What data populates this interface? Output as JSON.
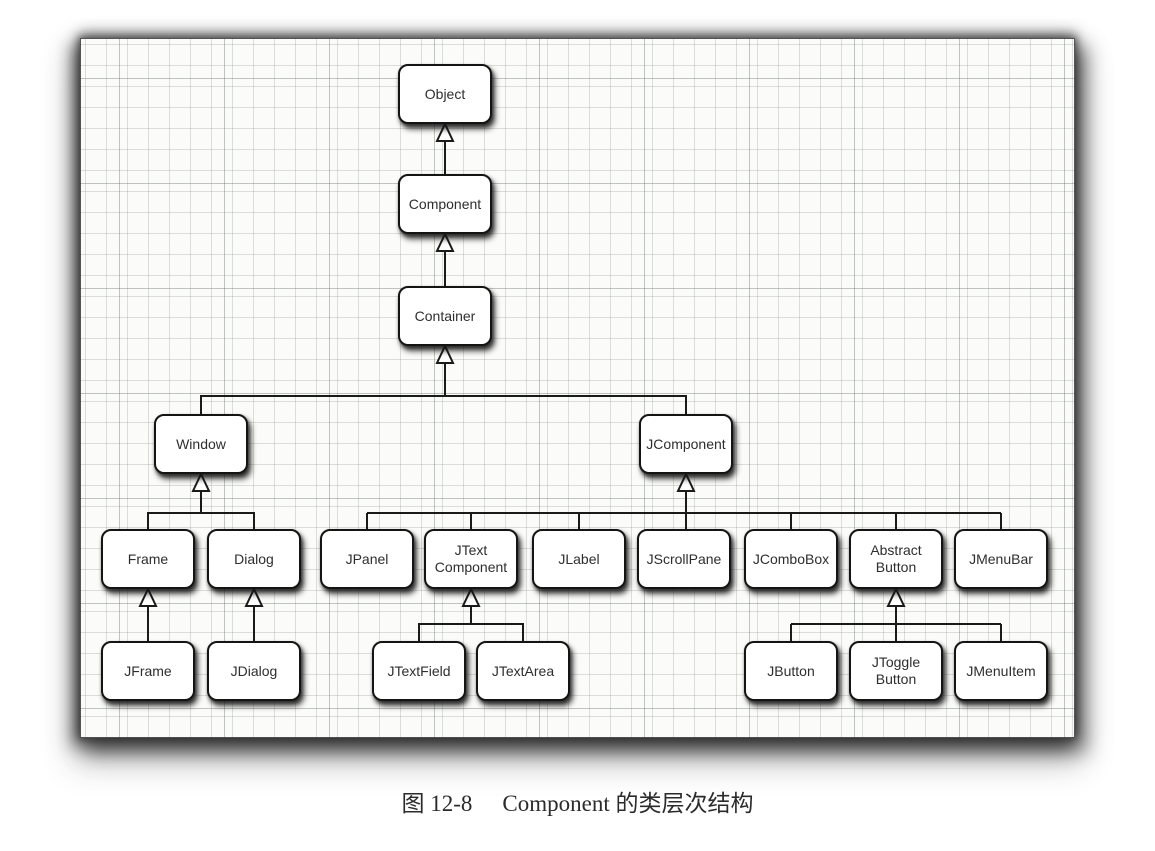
{
  "figure": {
    "caption": {
      "number": "图 12-8",
      "title": "Component 的类层次结构"
    }
  },
  "colors": {
    "node_fill": "#ffffff",
    "node_border": "#141414",
    "connector_line": "#1a1a1a",
    "paper_background": "#fbfbf9"
  },
  "diagram": {
    "type": "class-inheritance-hierarchy",
    "arrow_style": "hollow-triangle-pointing-to-parent",
    "nodes": [
      {
        "id": "Object",
        "label": "Object"
      },
      {
        "id": "Component",
        "label": "Component"
      },
      {
        "id": "Container",
        "label": "Container"
      },
      {
        "id": "Window",
        "label": "Window"
      },
      {
        "id": "JComponent",
        "label": "JComponent"
      },
      {
        "id": "Frame",
        "label": "Frame"
      },
      {
        "id": "Dialog",
        "label": "Dialog"
      },
      {
        "id": "JPanel",
        "label": "JPanel"
      },
      {
        "id": "JTextComponent",
        "label": "JText\nComponent"
      },
      {
        "id": "JLabel",
        "label": "JLabel"
      },
      {
        "id": "JScrollPane",
        "label": "JScrollPane"
      },
      {
        "id": "JComboBox",
        "label": "JComboBox"
      },
      {
        "id": "AbstractButton",
        "label": "Abstract\nButton"
      },
      {
        "id": "JMenuBar",
        "label": "JMenuBar"
      },
      {
        "id": "JFrame",
        "label": "JFrame"
      },
      {
        "id": "JDialog",
        "label": "JDialog"
      },
      {
        "id": "JTextField",
        "label": "JTextField"
      },
      {
        "id": "JTextArea",
        "label": "JTextArea"
      },
      {
        "id": "JButton",
        "label": "JButton"
      },
      {
        "id": "JToggleButton",
        "label": "JToggle\nButton"
      },
      {
        "id": "JMenuItem",
        "label": "JMenuItem"
      }
    ],
    "edges": [
      {
        "child": "Component",
        "parent": "Object",
        "relation": "extends"
      },
      {
        "child": "Container",
        "parent": "Component",
        "relation": "extends"
      },
      {
        "child": "Window",
        "parent": "Container",
        "relation": "extends"
      },
      {
        "child": "JComponent",
        "parent": "Container",
        "relation": "extends"
      },
      {
        "child": "Frame",
        "parent": "Window",
        "relation": "extends"
      },
      {
        "child": "Dialog",
        "parent": "Window",
        "relation": "extends"
      },
      {
        "child": "JPanel",
        "parent": "JComponent",
        "relation": "extends"
      },
      {
        "child": "JTextComponent",
        "parent": "JComponent",
        "relation": "extends"
      },
      {
        "child": "JLabel",
        "parent": "JComponent",
        "relation": "extends"
      },
      {
        "child": "JScrollPane",
        "parent": "JComponent",
        "relation": "extends"
      },
      {
        "child": "JComboBox",
        "parent": "JComponent",
        "relation": "extends"
      },
      {
        "child": "AbstractButton",
        "parent": "JComponent",
        "relation": "extends"
      },
      {
        "child": "JMenuBar",
        "parent": "JComponent",
        "relation": "extends"
      },
      {
        "child": "JFrame",
        "parent": "Frame",
        "relation": "extends"
      },
      {
        "child": "JDialog",
        "parent": "Dialog",
        "relation": "extends"
      },
      {
        "child": "JTextField",
        "parent": "JTextComponent",
        "relation": "extends"
      },
      {
        "child": "JTextArea",
        "parent": "JTextComponent",
        "relation": "extends"
      },
      {
        "child": "JButton",
        "parent": "AbstractButton",
        "relation": "extends"
      },
      {
        "child": "JToggleButton",
        "parent": "AbstractButton",
        "relation": "extends"
      },
      {
        "child": "JMenuItem",
        "parent": "AbstractButton",
        "relation": "extends"
      }
    ]
  }
}
